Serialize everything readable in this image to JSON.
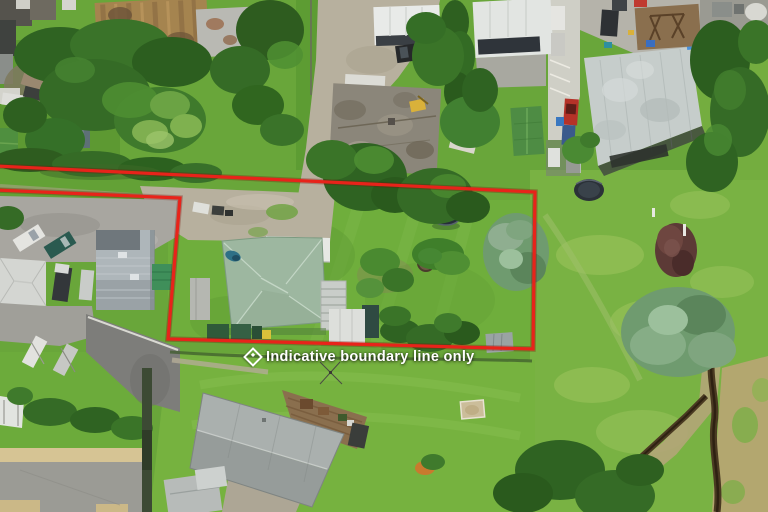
{
  "overlay": {
    "caption": "Indicative boundary line only",
    "icon": "diamond-outline-icon",
    "text_color": "#ffffff"
  },
  "boundary": {
    "color": "#e8231a",
    "halo_color": "#7a0c06",
    "stroke_width": "3.2",
    "points": "-4,190 180,198 168,339 533,349 535,192 -4,166"
  },
  "palette": {
    "lawn_green": "#6fae3c",
    "field_green": "#79b243",
    "house_roof_sage": "#9db7a0",
    "gravel": "#b7b09e",
    "asphalt": "#7d7d7a",
    "concrete_pad": "#9b9b95",
    "creek_brown": "#4a3a22",
    "dry_grass_tan": "#b3a76f",
    "big_roof_grey": "#c6cdcb",
    "rusty_roof": "#a5844f",
    "tarp_blue": "#4a90d9",
    "pool_dark": "#262e38",
    "car_red": "#b53228"
  }
}
